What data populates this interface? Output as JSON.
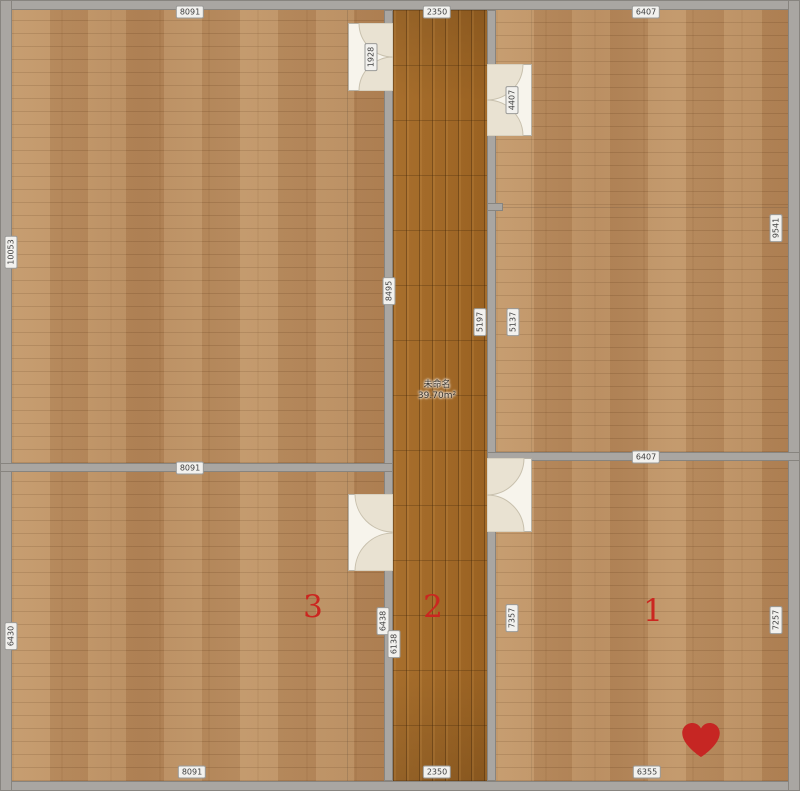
{
  "plan_title": "floor-plan",
  "corridor": {
    "name": "未命名",
    "area": "39.70m²"
  },
  "rooms": [
    {
      "number": "1",
      "x": 653,
      "y": 611
    },
    {
      "number": "2",
      "x": 433,
      "y": 607
    },
    {
      "number": "3",
      "x": 313,
      "y": 607
    }
  ],
  "heart": {
    "symbol": "heart",
    "x": 701,
    "y": 742,
    "color": "#c62623"
  },
  "dimensions": {
    "horizontal": [
      {
        "text": "8091",
        "x": 190,
        "y": 12
      },
      {
        "text": "2350",
        "x": 437,
        "y": 12
      },
      {
        "text": "6407",
        "x": 646,
        "y": 12
      },
      {
        "text": "8091",
        "x": 190,
        "y": 468
      },
      {
        "text": "6407",
        "x": 646,
        "y": 457
      },
      {
        "text": "8091",
        "x": 192,
        "y": 772
      },
      {
        "text": "2350",
        "x": 437,
        "y": 772
      },
      {
        "text": "6355",
        "x": 647,
        "y": 772
      }
    ],
    "vertical": [
      {
        "text": "10053",
        "x": 11,
        "y": 252
      },
      {
        "text": "6430",
        "x": 11,
        "y": 636
      },
      {
        "text": "9541",
        "x": 776,
        "y": 228
      },
      {
        "text": "7257",
        "x": 776,
        "y": 620
      },
      {
        "text": "1928",
        "x": 371,
        "y": 57
      },
      {
        "text": "8495",
        "x": 389,
        "y": 291
      },
      {
        "text": "6438",
        "x": 383,
        "y": 621
      },
      {
        "text": "6138",
        "x": 394,
        "y": 644
      },
      {
        "text": "4407",
        "x": 512,
        "y": 100
      },
      {
        "text": "5197",
        "x": 480,
        "y": 322
      },
      {
        "text": "5137",
        "x": 513,
        "y": 322
      },
      {
        "text": "7357",
        "x": 512,
        "y": 618
      }
    ]
  },
  "colors": {
    "wall": "#a9a6a2",
    "floor_light": "#b88c5f",
    "floor_dark": "#a06826",
    "door": "#f7f4ec",
    "door_fan": "#e9e2d2",
    "accent_red": "#cb2620"
  }
}
